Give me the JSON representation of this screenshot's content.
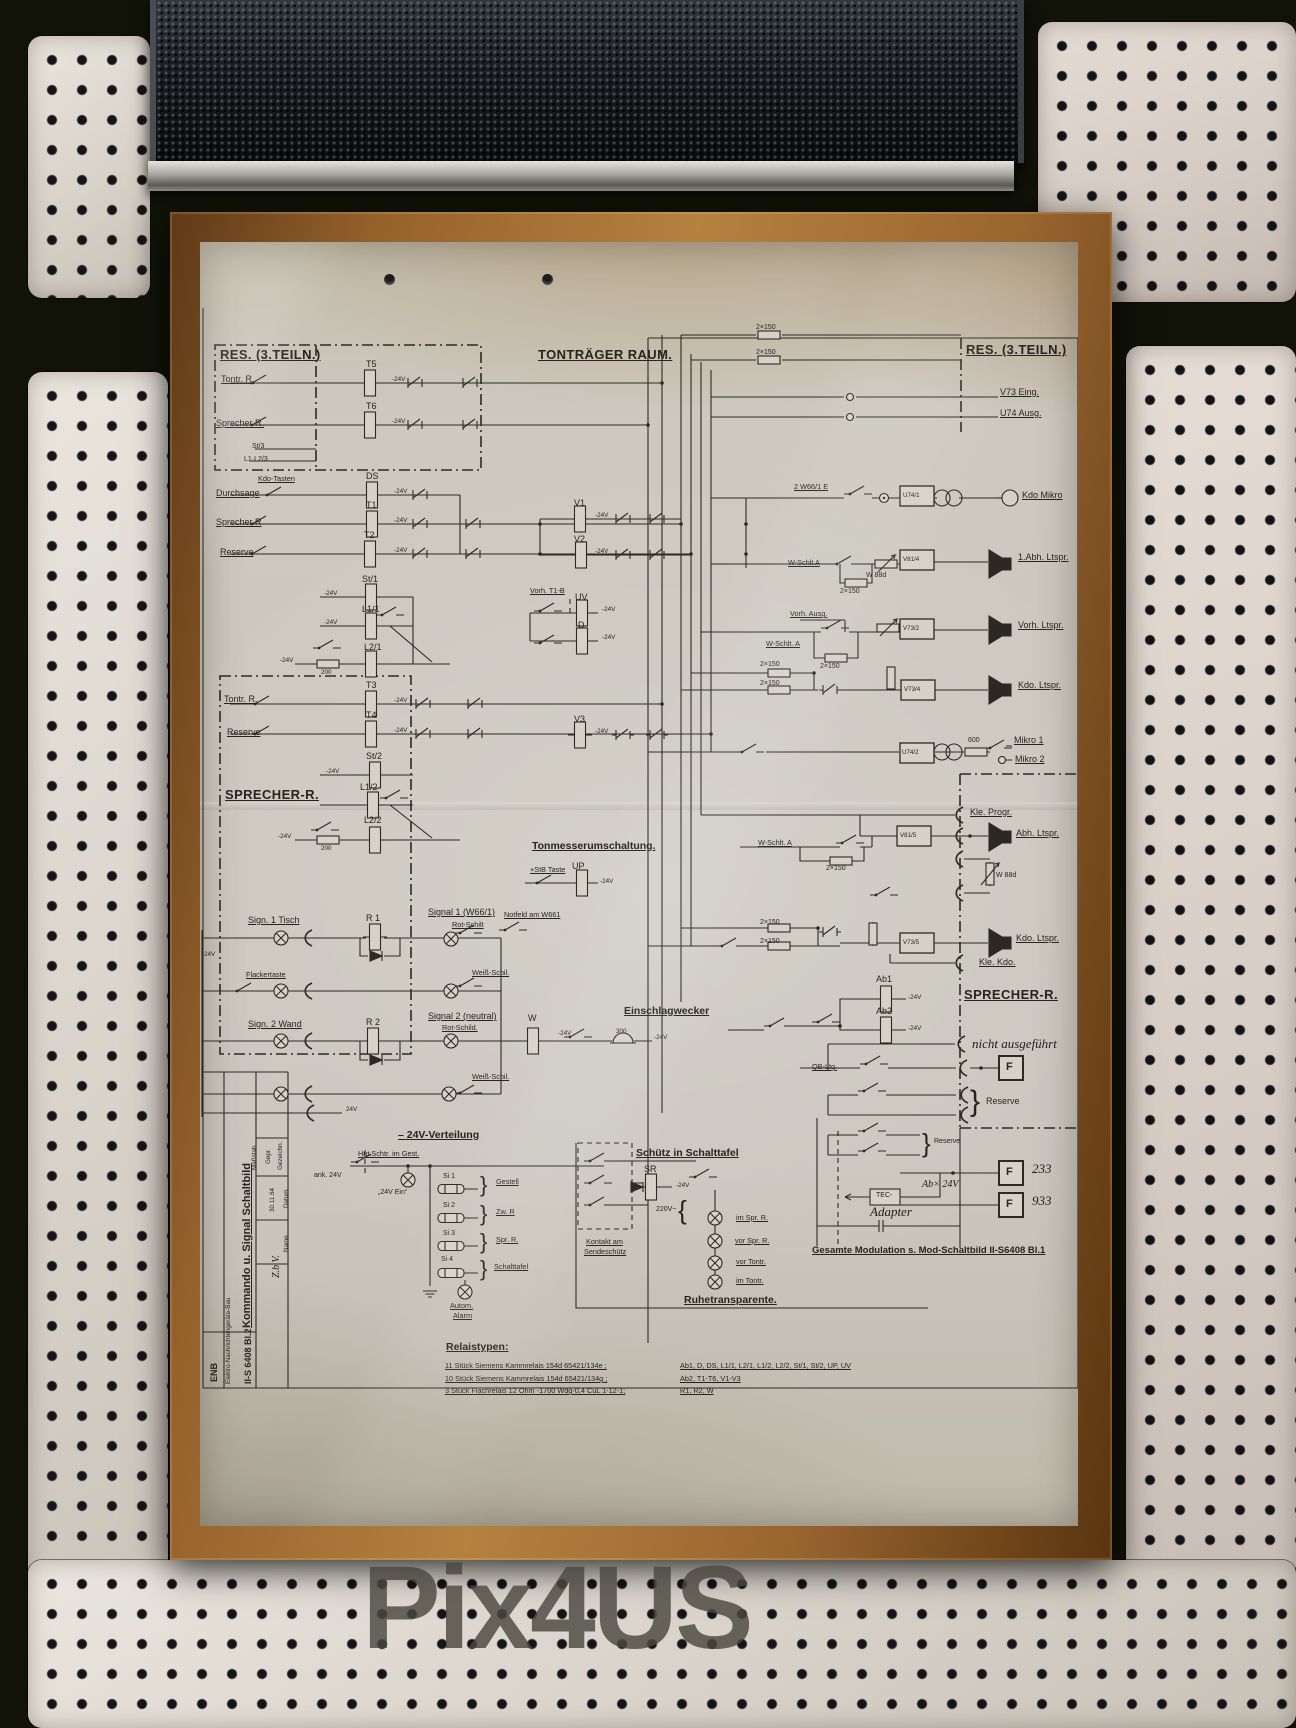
{
  "watermark": {
    "text": "Pix4US"
  },
  "diagram": {
    "sheet_title": "Kommando u. Signal Schaltbild",
    "sheet_number": "II-S 6408 Bl.2",
    "labels": [
      {
        "t": "RES. (3.TEILN.)",
        "x": 20,
        "y": 106,
        "c": "h1"
      },
      {
        "t": "Tontr. R.",
        "x": 21,
        "y": 133,
        "c": "lb"
      },
      {
        "t": "T5",
        "x": 166,
        "y": 118,
        "c": "nm"
      },
      {
        "t": "-24V",
        "x": 192,
        "y": 135,
        "c": "xs"
      },
      {
        "t": "Sprecher R.",
        "x": 16,
        "y": 177,
        "c": "lb"
      },
      {
        "t": "T6",
        "x": 166,
        "y": 160,
        "c": "nm"
      },
      {
        "t": "-24V",
        "x": 192,
        "y": 177,
        "c": "xs"
      },
      {
        "t": "St/3",
        "x": 52,
        "y": 201,
        "c": "sp"
      },
      {
        "t": "L1·L2/3",
        "x": 44,
        "y": 214,
        "c": "sp"
      },
      {
        "t": "TONTRÄGER RAUM.",
        "x": 338,
        "y": 106,
        "c": "h1"
      },
      {
        "t": "Kdo-Tasten",
        "x": 58,
        "y": 233,
        "c": "sm"
      },
      {
        "t": "Durchsage",
        "x": 16,
        "y": 247,
        "c": "lb"
      },
      {
        "t": "DS",
        "x": 166,
        "y": 230,
        "c": "nm"
      },
      {
        "t": "-24V",
        "x": 194,
        "y": 247,
        "c": "xs"
      },
      {
        "t": "Sprecher R",
        "x": 16,
        "y": 276,
        "c": "lb"
      },
      {
        "t": "T1",
        "x": 166,
        "y": 259,
        "c": "nm"
      },
      {
        "t": "-24V",
        "x": 194,
        "y": 276,
        "c": "xs"
      },
      {
        "t": "Reserve",
        "x": 20,
        "y": 306,
        "c": "lb"
      },
      {
        "t": "T2",
        "x": 164,
        "y": 289,
        "c": "nm"
      },
      {
        "t": "-24V",
        "x": 194,
        "y": 306,
        "c": "xs"
      },
      {
        "t": "St/1",
        "x": 162,
        "y": 333,
        "c": "nm"
      },
      {
        "t": "-24V",
        "x": 124,
        "y": 349,
        "c": "xs"
      },
      {
        "t": "L1/1",
        "x": 162,
        "y": 363,
        "c": "nm"
      },
      {
        "t": "-24V",
        "x": 124,
        "y": 378,
        "c": "xs"
      },
      {
        "t": "L2/1",
        "x": 164,
        "y": 401,
        "c": "nm"
      },
      {
        "t": "200",
        "x": 121,
        "y": 428,
        "c": "xs"
      },
      {
        "t": "-24V",
        "x": 80,
        "y": 416,
        "c": "xs"
      },
      {
        "t": "V1",
        "x": 374,
        "y": 257,
        "c": "nm"
      },
      {
        "t": "-24V",
        "x": 395,
        "y": 271,
        "c": "xs"
      },
      {
        "t": "V2",
        "x": 374,
        "y": 293,
        "c": "nm"
      },
      {
        "t": "-24V",
        "x": 395,
        "y": 307,
        "c": "xs"
      },
      {
        "t": "Vorh. T1-B",
        "x": 330,
        "y": 345,
        "c": "sm"
      },
      {
        "t": "UV",
        "x": 375,
        "y": 351,
        "c": "nm"
      },
      {
        "t": "-24V",
        "x": 402,
        "y": 365,
        "c": "xs"
      },
      {
        "t": "D",
        "x": 378,
        "y": 379,
        "c": "nm"
      },
      {
        "t": "-24V",
        "x": 402,
        "y": 393,
        "c": "xs"
      },
      {
        "t": "T3",
        "x": 166,
        "y": 439,
        "c": "nm"
      },
      {
        "t": "Tontr. R.",
        "x": 24,
        "y": 453,
        "c": "lb"
      },
      {
        "t": "-24V",
        "x": 194,
        "y": 456,
        "c": "xs"
      },
      {
        "t": "T4",
        "x": 166,
        "y": 469,
        "c": "nm"
      },
      {
        "t": "Reserve",
        "x": 27,
        "y": 486,
        "c": "lb"
      },
      {
        "t": "-24V",
        "x": 194,
        "y": 486,
        "c": "xs"
      },
      {
        "t": "St/2",
        "x": 166,
        "y": 510,
        "c": "nm"
      },
      {
        "t": "-24V",
        "x": 126,
        "y": 527,
        "c": "xs"
      },
      {
        "t": "L1/2",
        "x": 160,
        "y": 541,
        "c": "nm"
      },
      {
        "t": "L2/2",
        "x": 164,
        "y": 574,
        "c": "nm"
      },
      {
        "t": "200",
        "x": 121,
        "y": 604,
        "c": "xs"
      },
      {
        "t": "-24V",
        "x": 78,
        "y": 592,
        "c": "xs"
      },
      {
        "t": "SPRECHER-R.",
        "x": 25,
        "y": 546,
        "c": "h1"
      },
      {
        "t": "V3",
        "x": 374,
        "y": 473,
        "c": "nm"
      },
      {
        "t": "-24V",
        "x": 395,
        "y": 487,
        "c": "xs"
      },
      {
        "t": "Tonmesserumschaltung.",
        "x": 332,
        "y": 599,
        "c": "h2"
      },
      {
        "t": "+StB Taste",
        "x": 330,
        "y": 624,
        "c": "sm"
      },
      {
        "t": "UP",
        "x": 372,
        "y": 620,
        "c": "nm"
      },
      {
        "t": "-24V",
        "x": 400,
        "y": 637,
        "c": "xs"
      },
      {
        "t": "Sign. 1 Tisch",
        "x": 48,
        "y": 674,
        "c": "lb"
      },
      {
        "t": "R 1",
        "x": 166,
        "y": 672,
        "c": "nm"
      },
      {
        "t": "Signal 1 (W66/1)",
        "x": 228,
        "y": 666,
        "c": "lb"
      },
      {
        "t": "Rot-Schilt",
        "x": 252,
        "y": 679,
        "c": "sm"
      },
      {
        "t": "Notfeld am W661",
        "x": 304,
        "y": 669,
        "c": "sm"
      },
      {
        "t": "Flackertaste",
        "x": 46,
        "y": 729,
        "c": "sm"
      },
      {
        "t": "Weiß-Schil.",
        "x": 272,
        "y": 727,
        "c": "sm"
      },
      {
        "t": "Sign. 2 Wand",
        "x": 48,
        "y": 778,
        "c": "lb"
      },
      {
        "t": "R 2",
        "x": 166,
        "y": 776,
        "c": "nm"
      },
      {
        "t": "Signal 2 (neutral)",
        "x": 228,
        "y": 770,
        "c": "lb"
      },
      {
        "t": "Rot-Schild.",
        "x": 242,
        "y": 782,
        "c": "sm"
      },
      {
        "t": "W",
        "x": 328,
        "y": 772,
        "c": "nm"
      },
      {
        "t": "-24V",
        "x": 358,
        "y": 789,
        "c": "xs"
      },
      {
        "t": "Einschlagwecker",
        "x": 424,
        "y": 764,
        "c": "h2"
      },
      {
        "t": "300",
        "x": 416,
        "y": 787,
        "c": "xs"
      },
      {
        "t": "-24V",
        "x": 454,
        "y": 793,
        "c": "xs"
      },
      {
        "t": "Weiß-Schil.",
        "x": 272,
        "y": 831,
        "c": "sm"
      },
      {
        "t": "24V",
        "x": 146,
        "y": 865,
        "c": "xs"
      },
      {
        "t": "24V",
        "x": 4,
        "y": 710,
        "c": "xs"
      },
      {
        "t": "– 24V-Verteilung",
        "x": 198,
        "y": 888,
        "c": "h2"
      },
      {
        "t": "Hpt.Schtr. im Gest.",
        "x": 158,
        "y": 908,
        "c": "sm"
      },
      {
        "t": "ank. 24V",
        "x": 114,
        "y": 930,
        "c": "sp"
      },
      {
        "t": "„24V Ein“",
        "x": 178,
        "y": 947,
        "c": "sp"
      },
      {
        "t": "Si 1",
        "x": 243,
        "y": 931,
        "c": "sp"
      },
      {
        "t": "Gestell",
        "x": 296,
        "y": 936,
        "c": "sm"
      },
      {
        "t": "Si 2",
        "x": 243,
        "y": 960,
        "c": "sp"
      },
      {
        "t": "Zw. R",
        "x": 296,
        "y": 966,
        "c": "sm"
      },
      {
        "t": "Si 3",
        "x": 243,
        "y": 988,
        "c": "sp"
      },
      {
        "t": "Spr. R.",
        "x": 296,
        "y": 994,
        "c": "sm"
      },
      {
        "t": "Si 4",
        "x": 241,
        "y": 1014,
        "c": "sp"
      },
      {
        "t": "Schalttafel",
        "x": 294,
        "y": 1021,
        "c": "sm"
      },
      {
        "t": "Autom.",
        "x": 250,
        "y": 1060,
        "c": "sm"
      },
      {
        "t": "Alarm",
        "x": 253,
        "y": 1070,
        "c": "sm"
      },
      {
        "t": "}",
        "x": 280,
        "y": 932,
        "c": "br22"
      },
      {
        "t": "}",
        "x": 280,
        "y": 961,
        "c": "br22"
      },
      {
        "t": "}",
        "x": 280,
        "y": 989,
        "c": "br22"
      },
      {
        "t": "}",
        "x": 280,
        "y": 1016,
        "c": "br22"
      },
      {
        "t": "Schütz in Schalttafel",
        "x": 436,
        "y": 906,
        "c": "h2"
      },
      {
        "t": "SR",
        "x": 444,
        "y": 923,
        "c": "nm"
      },
      {
        "t": "-24V",
        "x": 476,
        "y": 941,
        "c": "xs"
      },
      {
        "t": "Kontakt am",
        "x": 386,
        "y": 996,
        "c": "sm"
      },
      {
        "t": "Sendeschütz",
        "x": 384,
        "y": 1006,
        "c": "sm"
      },
      {
        "t": "220V~",
        "x": 456,
        "y": 964,
        "c": "sp"
      },
      {
        "t": "{",
        "x": 478,
        "y": 955,
        "c": "br26"
      },
      {
        "t": "im Spr. R.",
        "x": 536,
        "y": 972,
        "c": "sm"
      },
      {
        "t": "vor Spr. R.",
        "x": 535,
        "y": 995,
        "c": "sm"
      },
      {
        "t": "vor Tontr.",
        "x": 536,
        "y": 1016,
        "c": "sm"
      },
      {
        "t": "im Tontr.",
        "x": 536,
        "y": 1035,
        "c": "sm"
      },
      {
        "t": "Ruhetransparente.",
        "x": 484,
        "y": 1053,
        "c": "h2"
      },
      {
        "t": "Relaistypen:",
        "x": 246,
        "y": 1100,
        "c": "h2"
      },
      {
        "t": "11 Stück   Siemens Kammrelais   154d 65421/134e ;",
        "x": 245,
        "y": 1120,
        "c": "sm"
      },
      {
        "t": "10 Stück   Siemens Kammrelais   154d 65421/134g ;",
        "x": 245,
        "y": 1133,
        "c": "sm"
      },
      {
        "t": "3  Stück   Flachrelais 12 Ohm -1700 Wdg-0,4 CuL 1-12-1;",
        "x": 245,
        "y": 1145,
        "c": "sm"
      },
      {
        "t": "Ab1, D, DS, L1/1, L2/1, L1/2, L2/2, St/1, St/2, UP, UV",
        "x": 480,
        "y": 1120,
        "c": "sm"
      },
      {
        "t": "Ab2, T1-T6, V1-V3",
        "x": 480,
        "y": 1133,
        "c": "sm"
      },
      {
        "t": "R1, R2, W",
        "x": 480,
        "y": 1145,
        "c": "sm"
      },
      {
        "t": "RES. (3.TEILN.)",
        "x": 766,
        "y": 101,
        "c": "h1"
      },
      {
        "t": "V73 Eing.",
        "x": 800,
        "y": 146,
        "c": "lb"
      },
      {
        "t": "U74 Ausg.",
        "x": 800,
        "y": 167,
        "c": "lb"
      },
      {
        "t": "2×150",
        "x": 556,
        "y": 82,
        "c": "sp"
      },
      {
        "t": "2×150",
        "x": 556,
        "y": 107,
        "c": "sp"
      },
      {
        "t": "2 W66/1 E",
        "x": 594,
        "y": 241,
        "c": "sm"
      },
      {
        "t": "U74/1",
        "x": 703,
        "y": 251,
        "c": "bx"
      },
      {
        "t": "Kdo Mikro",
        "x": 822,
        "y": 249,
        "c": "lb"
      },
      {
        "t": "W-Schlt A",
        "x": 588,
        "y": 317,
        "c": "sm"
      },
      {
        "t": "2×150",
        "x": 640,
        "y": 346,
        "c": "sp"
      },
      {
        "t": "W 88d",
        "x": 666,
        "y": 330,
        "c": "sp"
      },
      {
        "t": "V81/4",
        "x": 703,
        "y": 315,
        "c": "bx"
      },
      {
        "t": "1.Abh. Ltspr.",
        "x": 818,
        "y": 311,
        "c": "lb"
      },
      {
        "t": "Vorh. Ausg.",
        "x": 590,
        "y": 368,
        "c": "sm"
      },
      {
        "t": "W-Schlt. A",
        "x": 566,
        "y": 398,
        "c": "sm"
      },
      {
        "t": "2×150",
        "x": 620,
        "y": 421,
        "c": "sp"
      },
      {
        "t": "V73/2",
        "x": 703,
        "y": 384,
        "c": "bx"
      },
      {
        "t": "Vorh. Ltspr.",
        "x": 818,
        "y": 379,
        "c": "lb"
      },
      {
        "t": "2×150",
        "x": 560,
        "y": 419,
        "c": "sp"
      },
      {
        "t": "2×150",
        "x": 560,
        "y": 438,
        "c": "sp"
      },
      {
        "t": "V73/4",
        "x": 704,
        "y": 445,
        "c": "bx"
      },
      {
        "t": "Kdo. Ltspr.",
        "x": 818,
        "y": 439,
        "c": "lb"
      },
      {
        "t": "U74/2",
        "x": 702,
        "y": 508,
        "c": "bx"
      },
      {
        "t": "600",
        "x": 768,
        "y": 495,
        "c": "sp"
      },
      {
        "t": "Mikro 1",
        "x": 814,
        "y": 494,
        "c": "lb"
      },
      {
        "t": "Mikro 2",
        "x": 815,
        "y": 513,
        "c": "lb"
      },
      {
        "t": "Kle. Progr.",
        "x": 770,
        "y": 566,
        "c": "lb"
      },
      {
        "t": "V81/5",
        "x": 700,
        "y": 591,
        "c": "bx"
      },
      {
        "t": "Abh. Ltspr.",
        "x": 816,
        "y": 587,
        "c": "lb"
      },
      {
        "t": "W 88d",
        "x": 796,
        "y": 630,
        "c": "sp"
      },
      {
        "t": "W-Schlt. A",
        "x": 558,
        "y": 597,
        "c": "sm"
      },
      {
        "t": "2×150",
        "x": 626,
        "y": 623,
        "c": "sp"
      },
      {
        "t": "2×150",
        "x": 560,
        "y": 677,
        "c": "sp"
      },
      {
        "t": "2×150",
        "x": 560,
        "y": 696,
        "c": "sp"
      },
      {
        "t": "V73/5",
        "x": 703,
        "y": 698,
        "c": "bx"
      },
      {
        "t": "Kdo. Ltspr.",
        "x": 816,
        "y": 692,
        "c": "lb"
      },
      {
        "t": "Kle. Kdo.",
        "x": 779,
        "y": 716,
        "c": "lb"
      },
      {
        "t": "SPRECHER-R.",
        "x": 764,
        "y": 746,
        "c": "h1"
      },
      {
        "t": "Ab1",
        "x": 676,
        "y": 733,
        "c": "nm"
      },
      {
        "t": "-24V",
        "x": 708,
        "y": 753,
        "c": "xs"
      },
      {
        "t": "Ab2",
        "x": 676,
        "y": 765,
        "c": "nm"
      },
      {
        "t": "-24V",
        "x": 708,
        "y": 784,
        "c": "xs"
      },
      {
        "t": "nicht ausgeführt",
        "x": 772,
        "y": 795,
        "c": "hd"
      },
      {
        "t": "QB-Ltg.",
        "x": 612,
        "y": 821,
        "c": "sm"
      },
      {
        "t": "F",
        "x": 806,
        "y": 820,
        "c": "fb"
      },
      {
        "t": "Reserve",
        "x": 786,
        "y": 855,
        "c": "nm"
      },
      {
        "t": "}",
        "x": 770,
        "y": 845,
        "c": "br30"
      },
      {
        "t": "Reserve",
        "x": 734,
        "y": 896,
        "c": "sp"
      },
      {
        "t": "}",
        "x": 722,
        "y": 888,
        "c": "br26"
      },
      {
        "t": "F",
        "x": 806,
        "y": 925,
        "c": "fb"
      },
      {
        "t": "233",
        "x": 832,
        "y": 920,
        "c": "hd"
      },
      {
        "t": "F",
        "x": 806,
        "y": 957,
        "c": "fb"
      },
      {
        "t": "933",
        "x": 832,
        "y": 952,
        "c": "hd"
      },
      {
        "t": "Ab× 24V",
        "x": 722,
        "y": 938,
        "c": "hs"
      },
      {
        "t": "TEC-",
        "x": 676,
        "y": 950,
        "c": "sp"
      },
      {
        "t": "Adapter",
        "x": 670,
        "y": 963,
        "c": "hd"
      },
      {
        "t": "Gesamte Modulation s. Mod-Schaltbild II-S6408 Bl.1",
        "x": 612,
        "y": 1004,
        "c": "h2s"
      },
      {
        "t": "Maßstab",
        "x": 52,
        "y": 928,
        "c": "xs r"
      },
      {
        "t": "Gepr.",
        "x": 66,
        "y": 922,
        "c": "xs r"
      },
      {
        "t": "Gezeichn.",
        "x": 78,
        "y": 928,
        "c": "xs r"
      },
      {
        "t": "Datum",
        "x": 84,
        "y": 966,
        "c": "xs r"
      },
      {
        "t": "30.11.64",
        "x": 70,
        "y": 970,
        "c": "xs r"
      },
      {
        "t": "Name",
        "x": 84,
        "y": 1010,
        "c": "xs r"
      },
      {
        "t": "Z.b.V.",
        "x": 72,
        "y": 1036,
        "c": "hs r"
      },
      {
        "t": "Kommando u. Signal Schaltbild",
        "x": 42,
        "y": 1086,
        "c": "ttl r"
      },
      {
        "t": "ENB",
        "x": 10,
        "y": 1140,
        "c": "t2 r"
      },
      {
        "t": "Elektro-Nachrichtengeräte-Bau",
        "x": 26,
        "y": 1142,
        "c": "xs r"
      },
      {
        "t": "II-S 6408 Bl.2",
        "x": 44,
        "y": 1142,
        "c": "t2 r"
      }
    ]
  }
}
